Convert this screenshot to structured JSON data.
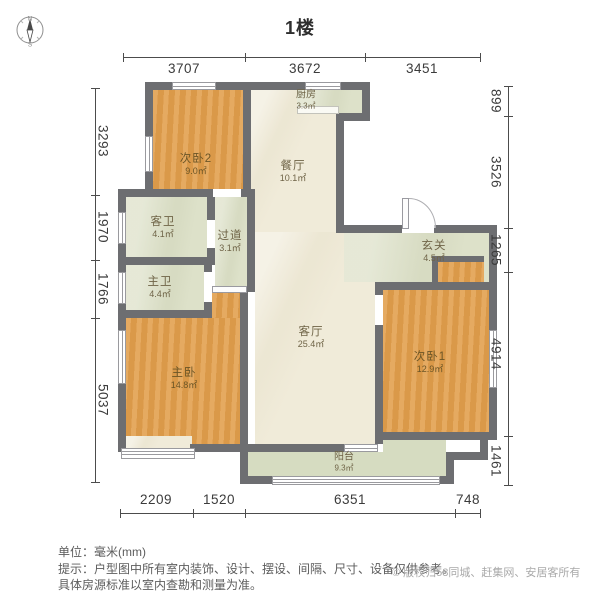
{
  "title": "1楼",
  "compass": {
    "north": "N",
    "south": "S"
  },
  "rooms": [
    {
      "id": "bedroom2",
      "name": "次卧2",
      "area": "9.0㎡"
    },
    {
      "id": "kitchen",
      "name": "厨房",
      "area": "3.3㎡"
    },
    {
      "id": "dining-room",
      "name": "餐厅",
      "area": "10.1㎡"
    },
    {
      "id": "guest-bathroom",
      "name": "客卫",
      "area": "4.1㎡"
    },
    {
      "id": "hallway",
      "name": "过道",
      "area": "3.1㎡"
    },
    {
      "id": "master-bathroom",
      "name": "主卫",
      "area": "4.4㎡"
    },
    {
      "id": "entryway",
      "name": "玄关",
      "area": "4.5㎡"
    },
    {
      "id": "living-room",
      "name": "客厅",
      "area": "25.4㎡"
    },
    {
      "id": "master-bedroom",
      "name": "主卧",
      "area": "14.8㎡"
    },
    {
      "id": "bedroom1",
      "name": "次卧1",
      "area": "12.9㎡"
    },
    {
      "id": "balcony",
      "name": "阳台",
      "area": "9.3㎡"
    }
  ],
  "dimensions": {
    "top": [
      "3707",
      "3672",
      "3451"
    ],
    "bottom": [
      "2209",
      "1520",
      "6351",
      "748"
    ],
    "left": [
      "3293",
      "1970",
      "1766",
      "5037"
    ],
    "right": [
      "899",
      "3526",
      "1265",
      "4914",
      "1461"
    ]
  },
  "footer": {
    "unit_line": "单位：毫米(mm)",
    "note_line1": "提示：户型图中所有室内装饰、设计、摆设、间隔、尺寸、设备仅供参考。",
    "note_line2": "具体房源标准以室内查勘和测量为准。",
    "copyright": "© 版权归58同城、赶集网、安居客所有"
  },
  "colors": {
    "wall": "#6d6e71",
    "bedroom_fill": "#e2a04f",
    "wet_area_fill": "#dde1c9",
    "hall_fill": "#f0ebd9"
  }
}
